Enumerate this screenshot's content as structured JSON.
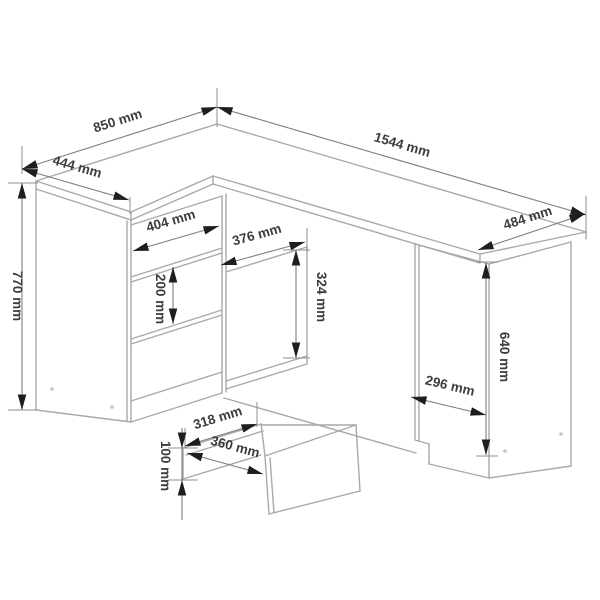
{
  "diagram": {
    "unit": "mm",
    "labels": {
      "d850": "850 mm",
      "d1544": "1544 mm",
      "d444": "444 mm",
      "d770": "770 mm",
      "d404": "404 mm",
      "d376": "376 mm",
      "d324": "324 mm",
      "d200": "200 mm",
      "d484": "484 mm",
      "d640": "640 mm",
      "d296": "296 mm",
      "d318": "318 mm",
      "d360": "360 mm",
      "d100": "100 mm"
    },
    "dimensions": [
      {
        "id": "left-wing-depth",
        "label": "850 mm",
        "value": 850
      },
      {
        "id": "total-width",
        "label": "1544 mm",
        "value": 1544
      },
      {
        "id": "left-wing-width",
        "label": "444 mm",
        "value": 444
      },
      {
        "id": "total-height",
        "label": "770 mm",
        "value": 770
      },
      {
        "id": "drawer-front-width",
        "label": "404 mm",
        "value": 404
      },
      {
        "id": "shelf-opening-width",
        "label": "376 mm",
        "value": 376
      },
      {
        "id": "shelf-opening-height",
        "label": "324 mm",
        "value": 324
      },
      {
        "id": "drawer-front-height",
        "label": "200 mm",
        "value": 200
      },
      {
        "id": "right-section-depth",
        "label": "484 mm",
        "value": 484
      },
      {
        "id": "side-panel-height",
        "label": "640 mm",
        "value": 640
      },
      {
        "id": "side-panel-base-width",
        "label": "296 mm",
        "value": 296
      },
      {
        "id": "drawer-inner-width",
        "label": "318 mm",
        "value": 318
      },
      {
        "id": "drawer-outer-width",
        "label": "360 mm",
        "value": 360
      },
      {
        "id": "drawer-box-height",
        "label": "100 mm",
        "value": 100
      }
    ]
  }
}
